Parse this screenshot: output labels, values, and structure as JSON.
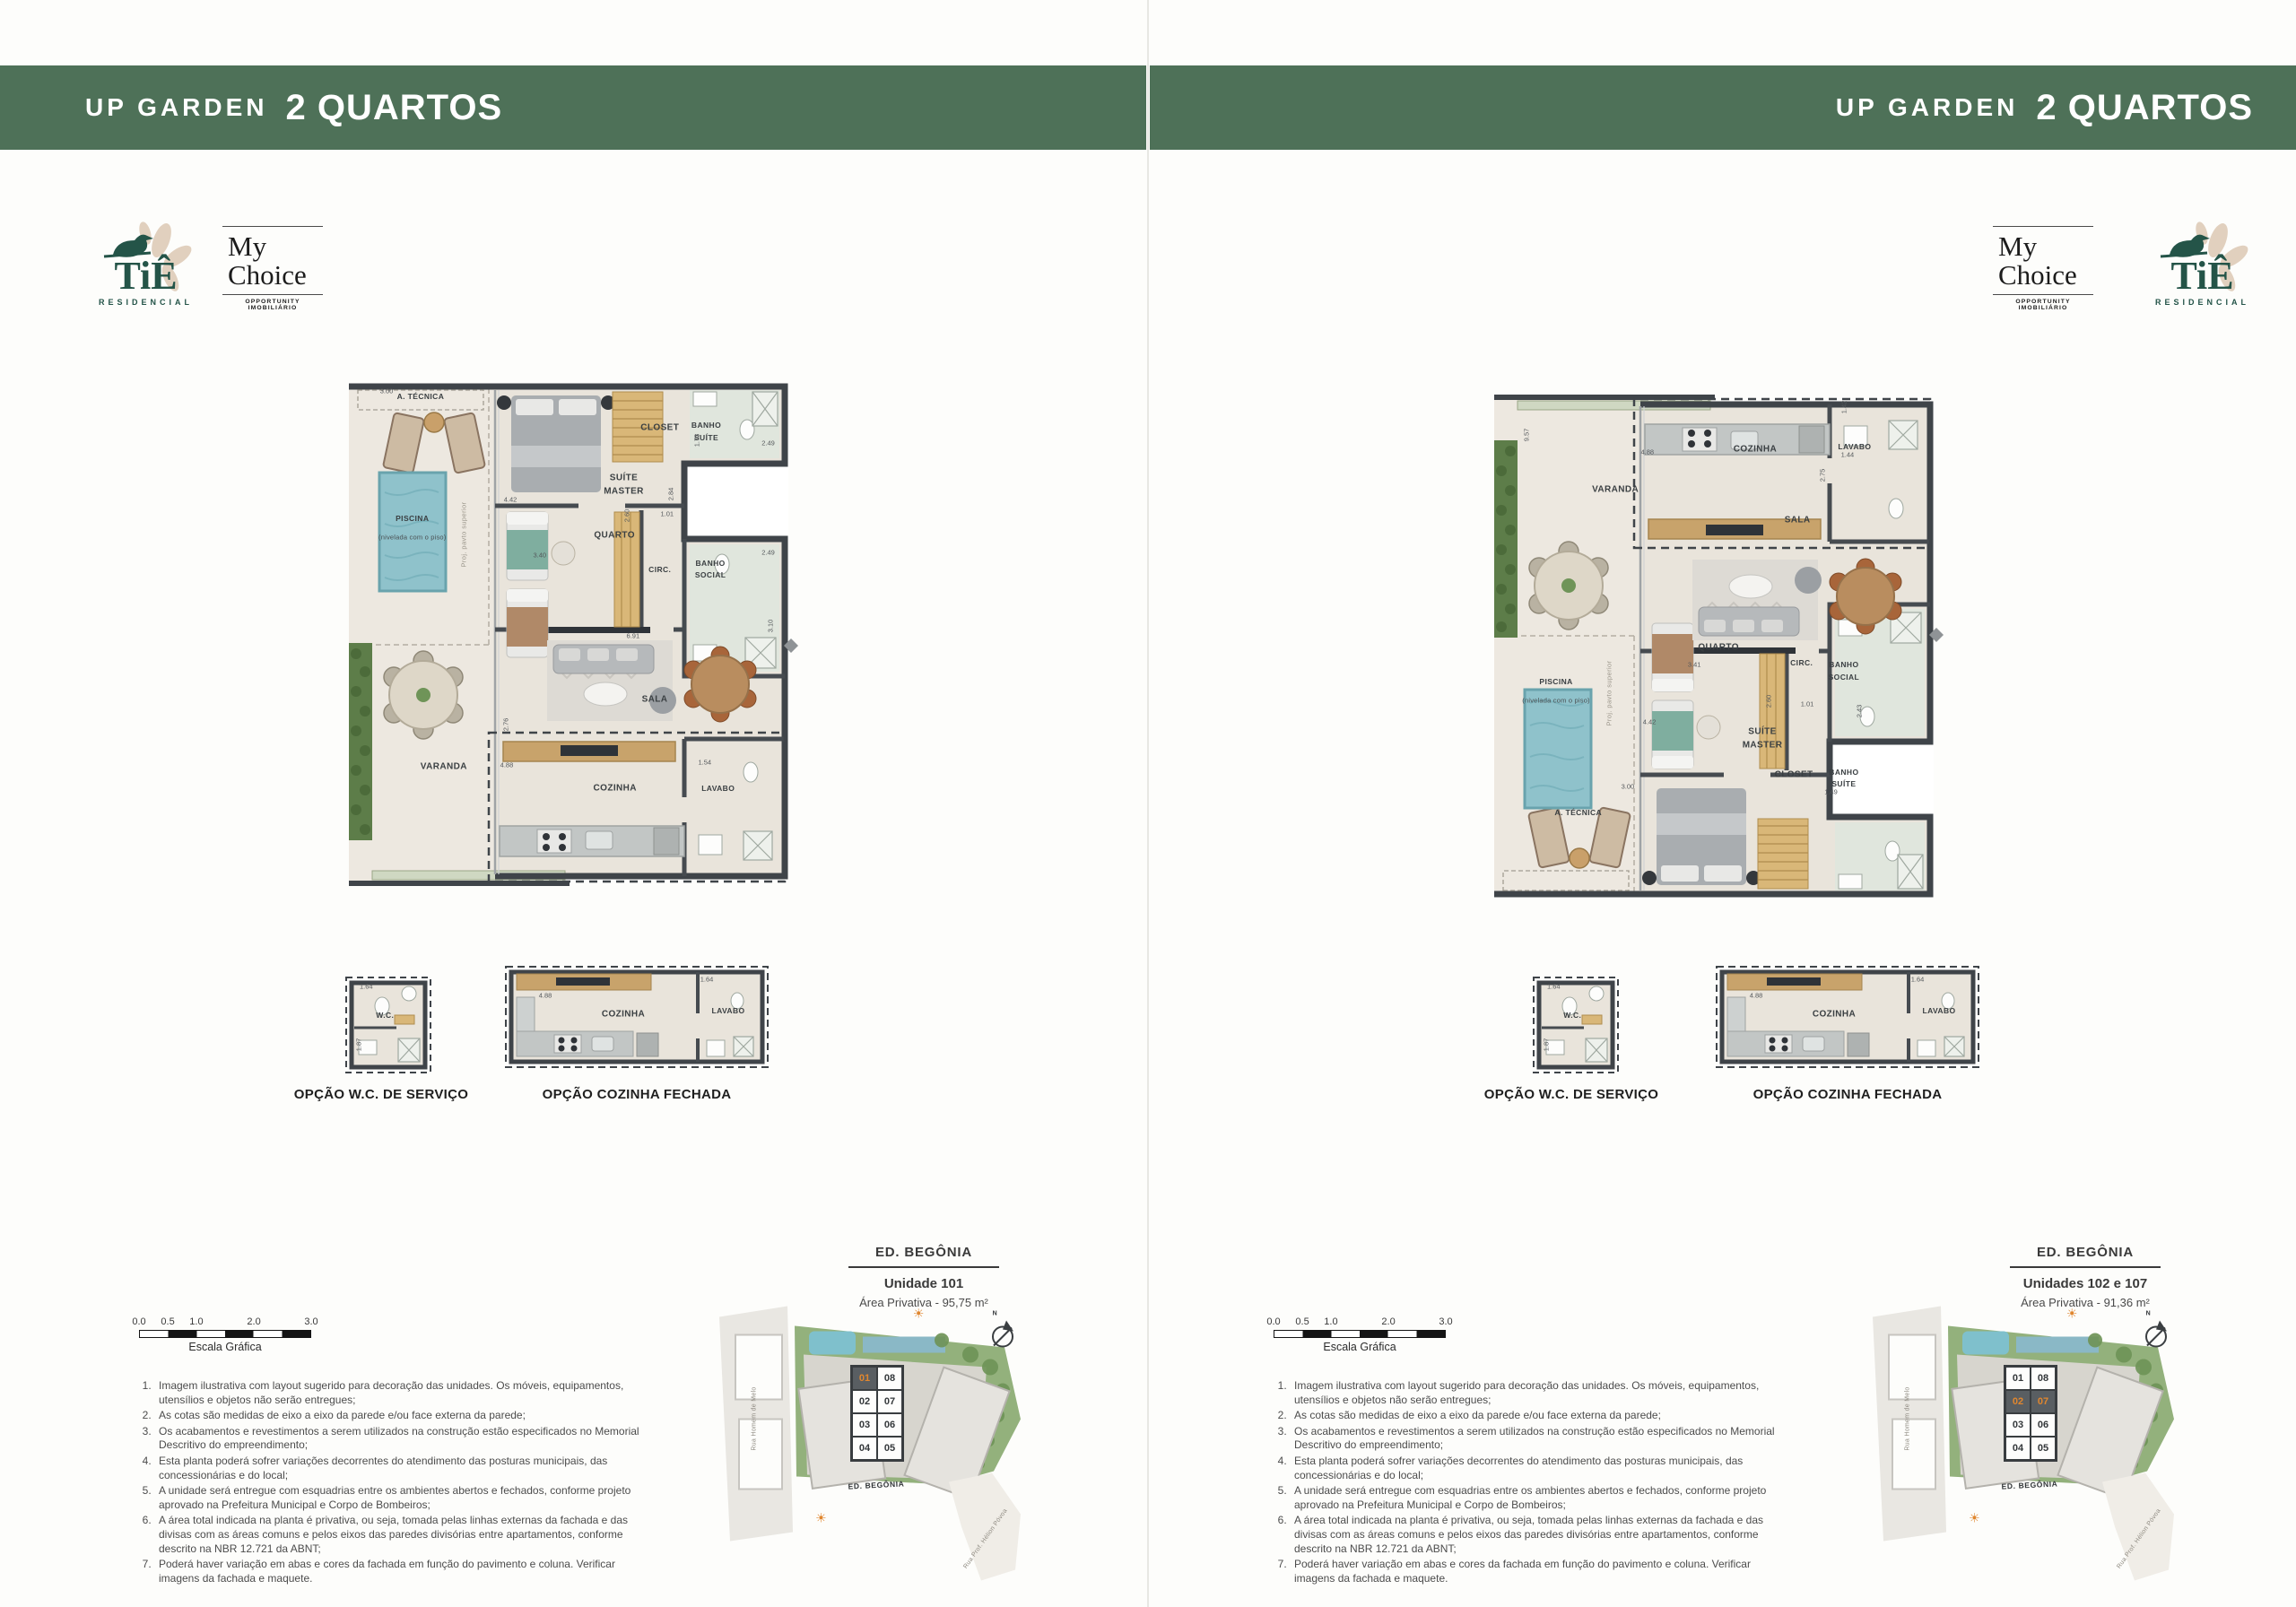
{
  "header": {
    "brand": "UP GARDEN",
    "title": "2 QUARTOS"
  },
  "colors": {
    "header_green": "#4e7158",
    "accent_orange": "#e0862e",
    "logo_green": "#245448",
    "wall_dark": "#3f4449",
    "pool_blue": "#8fc2cb"
  },
  "logos": {
    "tie": {
      "text": "TiÊ",
      "sub": "RESIDENCIAL"
    },
    "mychoice": {
      "line1": "My",
      "line2": "Choice",
      "sub": "OPPORTUNITY IMOBILIÁRIO"
    }
  },
  "scalebar": {
    "ticks": [
      "0.0",
      "0.5",
      "1.0",
      "2.0",
      "3.0"
    ],
    "label": "Escala Gráfica"
  },
  "notes": [
    "Imagem ilustrativa com layout sugerido para decoração das unidades. Os móveis, equipamentos, utensílios e objetos não serão entregues;",
    "As cotas são medidas de eixo a eixo da parede e/ou face externa da parede;",
    "Os acabamentos e revestimentos a serem utilizados na construção estão especificados no Memorial Descritivo do empreendimento;",
    "Esta planta poderá sofrer variações decorrentes do atendimento das posturas municipais, das concessionárias e do local;",
    "A unidade será entregue com esquadrias entre os ambientes abertos e fechados, conforme projeto aprovado na Prefeitura Municipal e Corpo de Bombeiros;",
    "A área total indicada na planta é privativa, ou seja, tomada pelas linhas externas da fachada e das divisas com as áreas comuns e pelos eixos das paredes divisórias entre apartamentos, conforme descrito na NBR 12.721 da ABNT;",
    "Poderá haver variação em abas e cores da fachada em função do pavimento e coluna. Verificar imagens da fachada e maquete."
  ],
  "options": {
    "wc_caption": "OPÇÃO W.C. DE SERVIÇO",
    "kitchen_caption": "OPÇÃO COZINHA FECHADA",
    "wc_labels": [
      {
        "t": "1.64",
        "x": 25,
        "y": 14,
        "cls": "dim"
      },
      {
        "t": "W.C.",
        "x": 45,
        "y": 40,
        "cls": "sm"
      },
      {
        "t": "1.87",
        "x": 17,
        "y": 66,
        "r": -90,
        "cls": "dim"
      }
    ],
    "kitchen_labels": [
      {
        "t": "4.88",
        "x": 16,
        "y": 30,
        "cls": "dim"
      },
      {
        "t": "COZINHA",
        "x": 45,
        "y": 47
      },
      {
        "t": "LAVABO",
        "x": 84,
        "y": 44,
        "cls": "sm"
      },
      {
        "t": "1.64",
        "x": 76,
        "y": 16,
        "cls": "dim"
      }
    ]
  },
  "sitemap": {
    "units": [
      [
        "01",
        "08"
      ],
      [
        "02",
        "07"
      ],
      [
        "03",
        "06"
      ],
      [
        "04",
        "05"
      ]
    ],
    "labels": [
      {
        "t": "ED. BEGÔNIA",
        "x": 52,
        "y": 62,
        "r": -3,
        "cls": "mapb"
      },
      {
        "t": "Rua Homem de Melo",
        "x": 12,
        "y": 40,
        "r": -90,
        "cls": "street"
      },
      {
        "t": "Rua Prof. Hélion Póvoa",
        "x": 88,
        "y": 80,
        "r": -55,
        "cls": "street"
      },
      {
        "t": "☀",
        "x": 66,
        "y": 5,
        "cls": "sun"
      },
      {
        "t": "☀",
        "x": 34,
        "y": 73,
        "cls": "sun"
      },
      {
        "t": "N",
        "x": 91,
        "y": 5,
        "cls": "northn"
      }
    ]
  },
  "pages": {
    "left": {
      "unit": {
        "building": "ED. BEGÔNIA",
        "unit": "Unidade 101",
        "area": "Área Privativa - 95,75 m²"
      },
      "sitemap_highlight": [
        "01"
      ],
      "plan_labels": [
        {
          "t": "A. TÉCNICA",
          "x": 14.6,
          "y": 4.1,
          "cls": "sm"
        },
        {
          "t": "PISCINA",
          "x": 13,
          "y": 27.1,
          "cls": "sm"
        },
        {
          "t": "(nivelada com o piso)",
          "x": 13,
          "y": 30.6,
          "cls": "sub"
        },
        {
          "t": "SUÍTE",
          "x": 54,
          "y": 19.5
        },
        {
          "t": "MASTER",
          "x": 54,
          "y": 21.9
        },
        {
          "t": "CLOSET",
          "x": 61,
          "y": 10
        },
        {
          "t": "BANHO",
          "x": 70,
          "y": 9.5,
          "cls": "sm"
        },
        {
          "t": "SUÍTE",
          "x": 70,
          "y": 11.8,
          "cls": "sm"
        },
        {
          "t": "QUARTO",
          "x": 52.2,
          "y": 30.3
        },
        {
          "t": "CIRC.",
          "x": 61,
          "y": 36.6,
          "cls": "sm"
        },
        {
          "t": "BANHO",
          "x": 70.8,
          "y": 35.4,
          "cls": "sm"
        },
        {
          "t": "SOCIAL",
          "x": 70.8,
          "y": 37.7,
          "cls": "sm"
        },
        {
          "t": "SALA",
          "x": 60,
          "y": 61.2
        },
        {
          "t": "VARANDA",
          "x": 19.1,
          "y": 73.9
        },
        {
          "t": "COZINHA",
          "x": 52.3,
          "y": 77.8
        },
        {
          "t": "LAVABO",
          "x": 72.3,
          "y": 77.8,
          "cls": "sm"
        },
        {
          "t": "Proj. pavto superior",
          "x": 23,
          "y": 30,
          "r": -90,
          "cls": "tiny"
        },
        {
          "t": "3.00",
          "x": 8,
          "y": 3,
          "cls": "dim"
        },
        {
          "t": "4.42",
          "x": 32,
          "y": 23.4,
          "cls": "dim"
        },
        {
          "t": "2.84",
          "x": 63.1,
          "y": 22.4,
          "r": -90,
          "cls": "dim"
        },
        {
          "t": "1.01",
          "x": 62.4,
          "y": 26.1,
          "cls": "dim"
        },
        {
          "t": "2.60",
          "x": 54.6,
          "y": 26.6,
          "r": -90,
          "cls": "dim"
        },
        {
          "t": "2.49",
          "x": 82,
          "y": 12.9,
          "cls": "dim"
        },
        {
          "t": "1.73",
          "x": 68.2,
          "y": 12.4,
          "r": -90,
          "cls": "dim"
        },
        {
          "t": "2.49",
          "x": 82,
          "y": 33.4,
          "cls": "dim"
        },
        {
          "t": "3.40",
          "x": 37.7,
          "y": 33.9,
          "cls": "dim"
        },
        {
          "t": "6.91",
          "x": 55.8,
          "y": 49.2,
          "cls": "dim"
        },
        {
          "t": "2.76",
          "x": 31.1,
          "y": 65.9,
          "r": -90,
          "cls": "dim"
        },
        {
          "t": "4.88",
          "x": 31.3,
          "y": 73.4,
          "cls": "dim"
        },
        {
          "t": "1.54",
          "x": 69.7,
          "y": 73,
          "cls": "dim"
        },
        {
          "t": "3.10",
          "x": 82.4,
          "y": 47.3,
          "r": -90,
          "cls": "dim"
        }
      ]
    },
    "right": {
      "unit": {
        "building": "ED. BEGÔNIA",
        "unit": "Unidades 102 e 107",
        "area": "Área Privativa - 91,36 m²"
      },
      "sitemap_highlight": [
        "02",
        "07"
      ],
      "plan_labels": [
        {
          "t": "COZINHA",
          "x": 51.3,
          "y": 14
        },
        {
          "t": "VARANDA",
          "x": 24.2,
          "y": 21.7
        },
        {
          "t": "LAVABO",
          "x": 70.6,
          "y": 13.5,
          "cls": "sm"
        },
        {
          "t": "SALA",
          "x": 59.5,
          "y": 27.3
        },
        {
          "t": "QUARTO",
          "x": 44.2,
          "y": 51.4
        },
        {
          "t": "CIRC.",
          "x": 60.3,
          "y": 54.2,
          "cls": "sm"
        },
        {
          "t": "BANHO",
          "x": 68.5,
          "y": 54.6,
          "cls": "sm"
        },
        {
          "t": "SOCIAL",
          "x": 68.5,
          "y": 56.9,
          "cls": "sm"
        },
        {
          "t": "PISCINA",
          "x": 12.7,
          "y": 57.8,
          "cls": "sm"
        },
        {
          "t": "(nivelada com o piso)",
          "x": 12.7,
          "y": 61.3,
          "cls": "sub"
        },
        {
          "t": "SUÍTE",
          "x": 52.7,
          "y": 67.3
        },
        {
          "t": "MASTER",
          "x": 52.7,
          "y": 69.7
        },
        {
          "t": "CLOSET",
          "x": 58.8,
          "y": 75.4
        },
        {
          "t": "BANHO",
          "x": 68.5,
          "y": 74.8,
          "cls": "sm"
        },
        {
          "t": "SUÍTE",
          "x": 68.5,
          "y": 77.1,
          "cls": "sm"
        },
        {
          "t": "A. TÉCNICA",
          "x": 17,
          "y": 82.5,
          "cls": "sm"
        },
        {
          "t": "Proj. pavto superior",
          "x": 23,
          "y": 60,
          "r": -90,
          "cls": "tiny"
        },
        {
          "t": "9.57",
          "x": 7,
          "y": 11.4,
          "r": -90,
          "cls": "dim"
        },
        {
          "t": "4.88",
          "x": 30.4,
          "y": 14.6,
          "cls": "dim"
        },
        {
          "t": "1.42",
          "x": 68.5,
          "y": 6.1,
          "r": -90,
          "cls": "dim"
        },
        {
          "t": "1.44",
          "x": 69.2,
          "y": 15.1,
          "cls": "dim"
        },
        {
          "t": "2.75",
          "x": 64.3,
          "y": 19,
          "r": -90,
          "cls": "dim"
        },
        {
          "t": "3.41",
          "x": 39.5,
          "y": 54.6,
          "cls": "dim"
        },
        {
          "t": "2.60",
          "x": 53.9,
          "y": 61.5,
          "r": -90,
          "cls": "dim"
        },
        {
          "t": "1.01",
          "x": 61.4,
          "y": 62,
          "cls": "dim"
        },
        {
          "t": "4.42",
          "x": 30.8,
          "y": 65.3,
          "cls": "dim"
        },
        {
          "t": "2.43",
          "x": 71.5,
          "y": 63.4,
          "r": -90,
          "cls": "dim"
        },
        {
          "t": "3.00",
          "x": 26.6,
          "y": 77.5,
          "cls": "dim"
        },
        {
          "t": "1.49",
          "x": 66,
          "y": 78.5,
          "cls": "dim"
        }
      ]
    }
  }
}
